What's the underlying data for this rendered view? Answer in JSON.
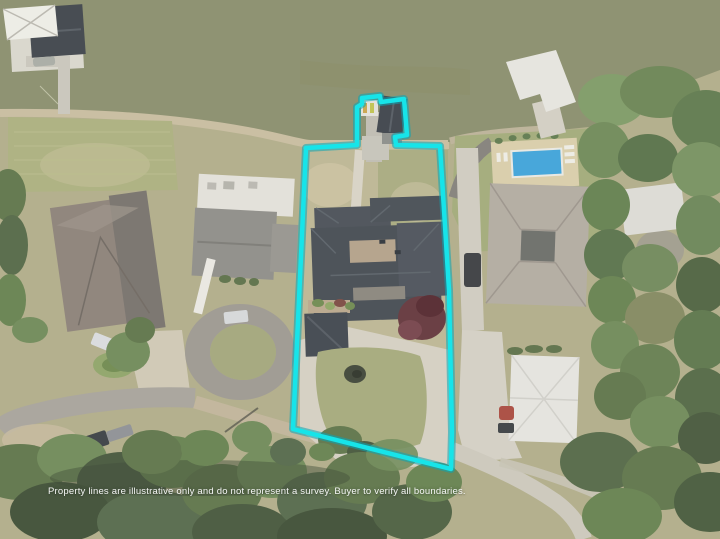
{
  "photo": {
    "description": "Aerial drone photo of a lakefront lot with highlighted property lines",
    "disclaimer": "Property lines are illustrative only and do not represent a survey. Buyer to verify all boundaries."
  },
  "colors": {
    "boundary": "#17E4E9",
    "boundary_halo": "#0AA6B4",
    "water": "#8A8E6C",
    "pool": "#3FA3D8",
    "subject_roof": "#454B52",
    "concrete": "#D4CFC1",
    "island_grass": "#A5A97B"
  }
}
